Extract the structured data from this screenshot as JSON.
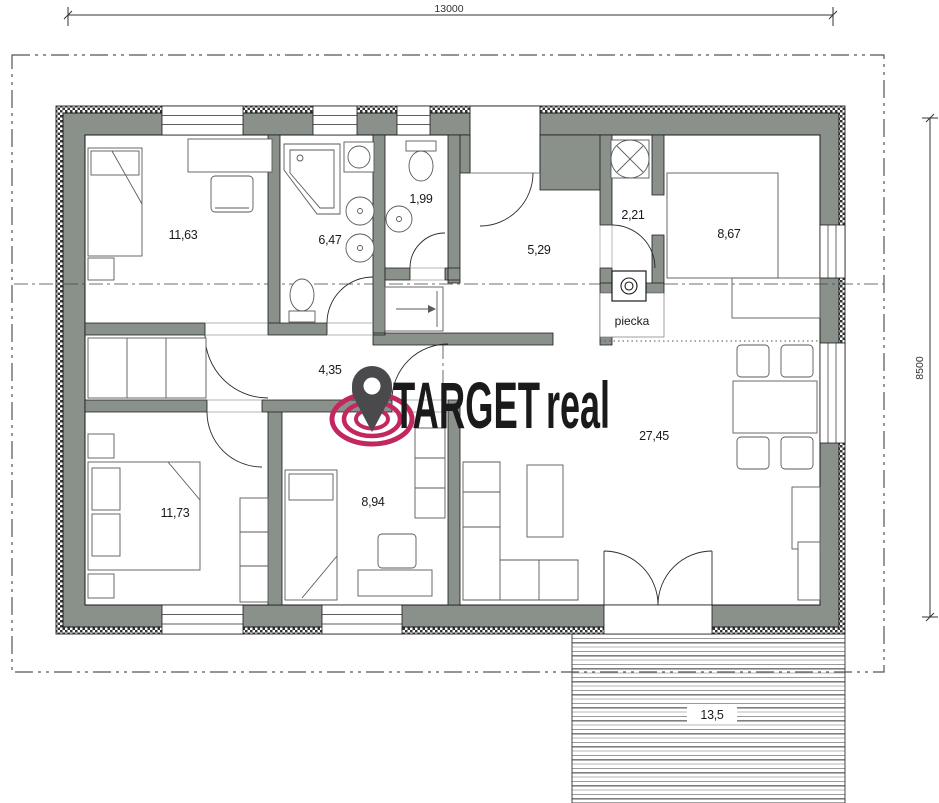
{
  "plan": {
    "dimension_width": "13000",
    "dimension_height": "8500",
    "rooms": {
      "bedroom_top": "11,63",
      "bathroom": "6,47",
      "wc": "1,99",
      "hall": "5,29",
      "utility": "2,21",
      "kitchen": "8,67",
      "corridor": "4,35",
      "bedroom_left": "11,73",
      "bedroom_middle": "8,94",
      "living_room": "27,45",
      "terrace": "13,5"
    },
    "stove_label": "piecka"
  },
  "logo": {
    "word_primary": "TARGET",
    "word_accent": "real"
  },
  "colors": {
    "wall": "#8a918a",
    "logo_dark": "#4a4a4c",
    "logo_accent": "#c2275f",
    "line": "#1a1a1a"
  }
}
